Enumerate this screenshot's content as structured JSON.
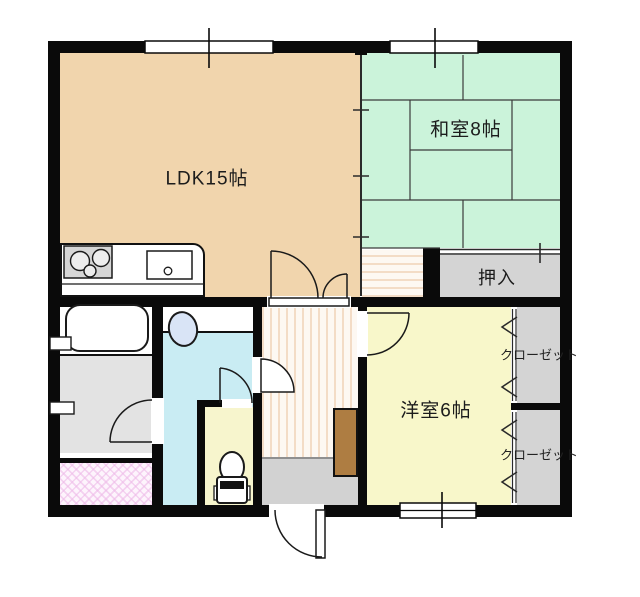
{
  "rooms": {
    "ldk": {
      "label": "LDK15帖"
    },
    "washitsu": {
      "label": "和室8帖"
    },
    "oshiire": {
      "label": "押入"
    },
    "youshitsu": {
      "label": "洋室6帖"
    },
    "closet_upper": {
      "label": "クローゼット"
    },
    "closet_lower": {
      "label": "クローゼット"
    }
  },
  "colors": {
    "ldk_floor": "#f1d5ad",
    "tatami_green": "#cbf3da",
    "western_room_yellow": "#f8f7ca",
    "toilet_room_yellow": "#f7f5cd",
    "washroom_cyan": "#c9ecf3",
    "storage_gray": "#d4d4d4",
    "entrance_gray": "#d2d2d2",
    "shower_floor_gray": "#e3e3e3",
    "tile_pink": "#f3d6ef",
    "cabinet_brown": "#ae7d42",
    "fixture_blue": "#d9e4f6",
    "wall_black": "#0a0a0a"
  }
}
